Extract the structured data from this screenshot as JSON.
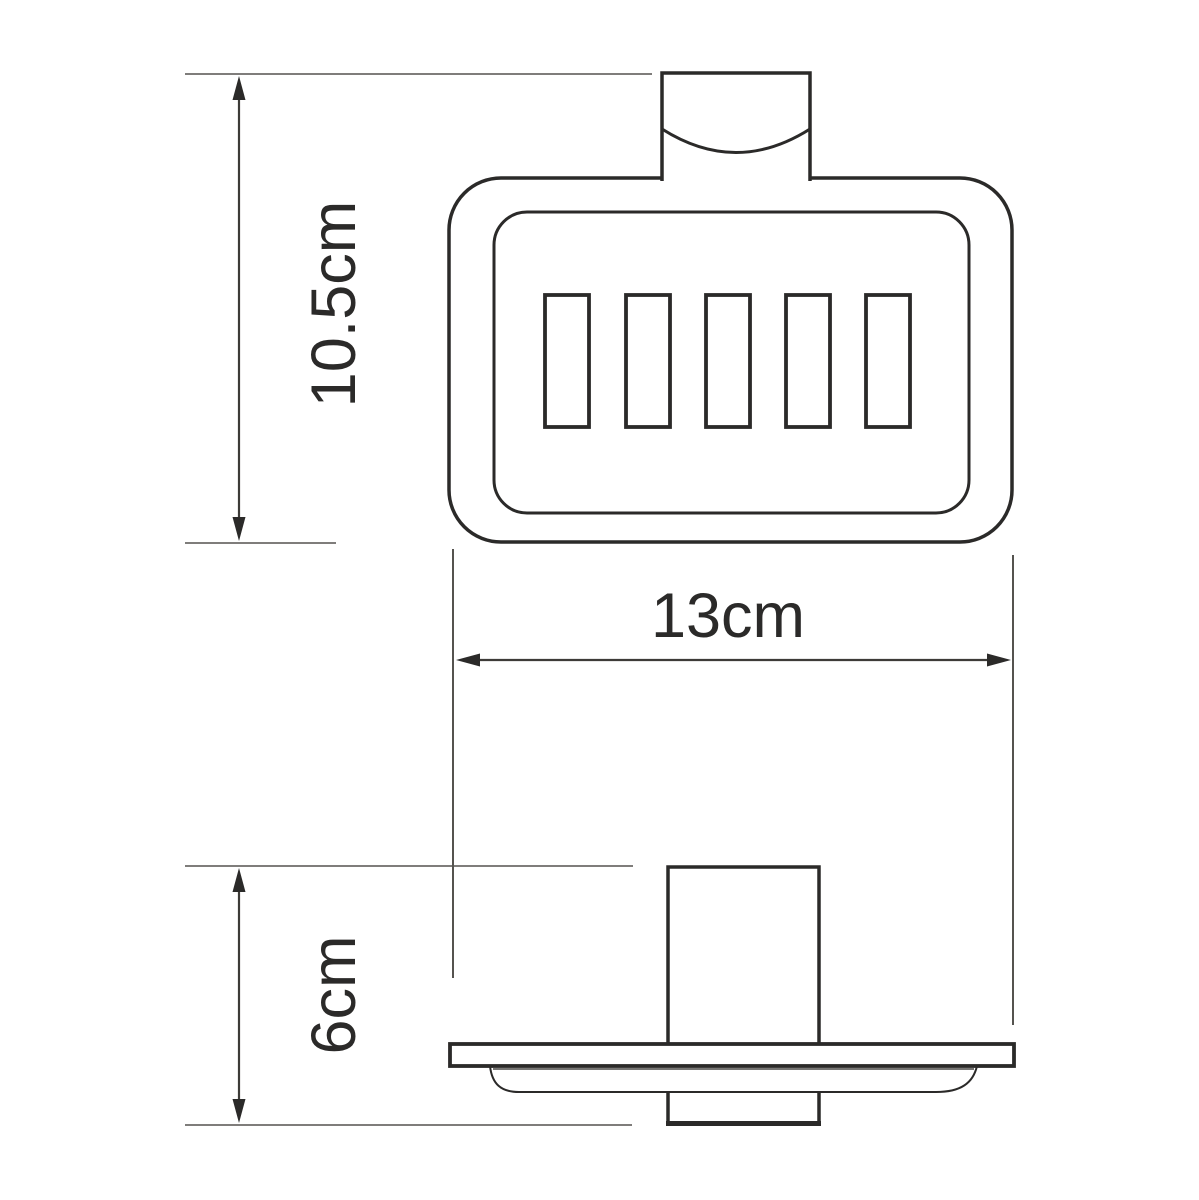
{
  "dimensions": {
    "height_label": "10.5cm",
    "width_label": "13cm",
    "depth_label": "6cm"
  },
  "front_view": {
    "slot_count": 5
  },
  "colors": {
    "object_line": "#2b2a29",
    "dimension_line": "#3d3b38",
    "extension_line": "#7f7d7b",
    "background": "#ffffff"
  }
}
